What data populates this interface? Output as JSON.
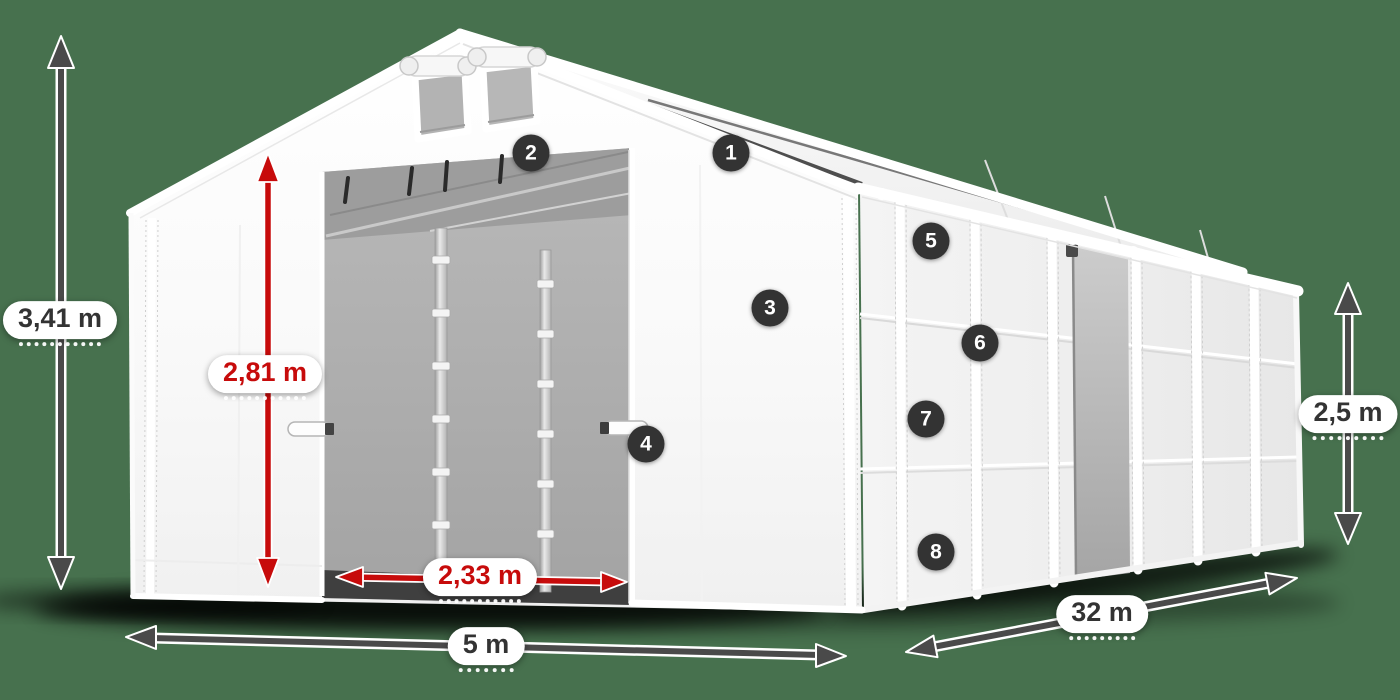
{
  "scene": {
    "description": "White modular storage tent 5 x 32 m product diagram with dimension arrows and numbered feature callouts",
    "background_color": "#47714e"
  },
  "dimensions": {
    "total_height": {
      "label": "3,41 m",
      "style": "gray"
    },
    "clear_height": {
      "label": "2,81 m",
      "style": "red"
    },
    "door_width": {
      "label": "2,33 m",
      "style": "red"
    },
    "front_width": {
      "label": "5 m",
      "style": "gray"
    },
    "length": {
      "label": "32 m",
      "style": "gray"
    },
    "side_height": {
      "label": "2,5 m",
      "style": "gray"
    }
  },
  "callouts": {
    "c1": "1",
    "c2": "2",
    "c3": "3",
    "c4": "4",
    "c5": "5",
    "c6": "6",
    "c7": "7",
    "c8": "8"
  },
  "colors": {
    "background": "#47714e",
    "arrow_gray": "#4a4a4a",
    "arrow_red": "#c70b0b",
    "label_text_dark": "#333333",
    "label_text_red": "#c70b0b",
    "callout_background": "#333333",
    "callout_text": "#ffffff",
    "tent_white": "#ffffff",
    "interior_gray": "#a9a9a9"
  }
}
